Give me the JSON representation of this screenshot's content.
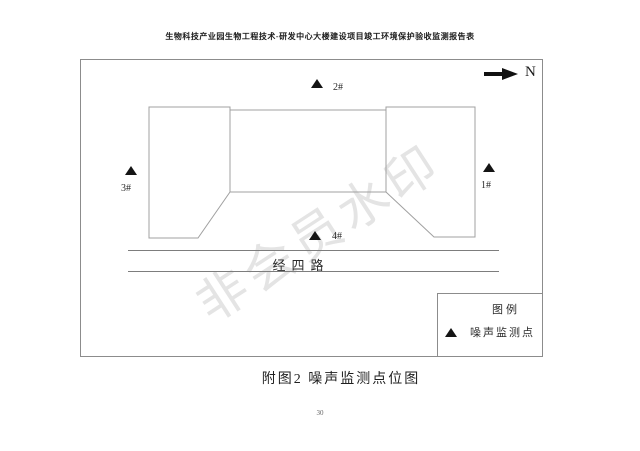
{
  "page": {
    "header_title": "生物科技产业园生物工程技术-研发中心大楼建设项目竣工环境保护验收监测报告表",
    "caption": "附图2 噪声监测点位图",
    "page_number": "30",
    "watermark": "非会员水印"
  },
  "diagram": {
    "north_label": "N",
    "road_label": "经四路",
    "points": [
      {
        "id": "point-1",
        "label": "1#"
      },
      {
        "id": "point-2",
        "label": "2#"
      },
      {
        "id": "point-3",
        "label": "3#"
      },
      {
        "id": "point-4",
        "label": "4#"
      }
    ],
    "legend": {
      "title": "图例",
      "items": [
        {
          "symbol": "noise-monitor-triangle",
          "label": "噪声监测点"
        }
      ]
    },
    "colors": {
      "outline_line": "#a0a0a0",
      "road_line": "#7d7d7d",
      "marker": "#141414",
      "watermark": "#e4e4e4"
    }
  }
}
